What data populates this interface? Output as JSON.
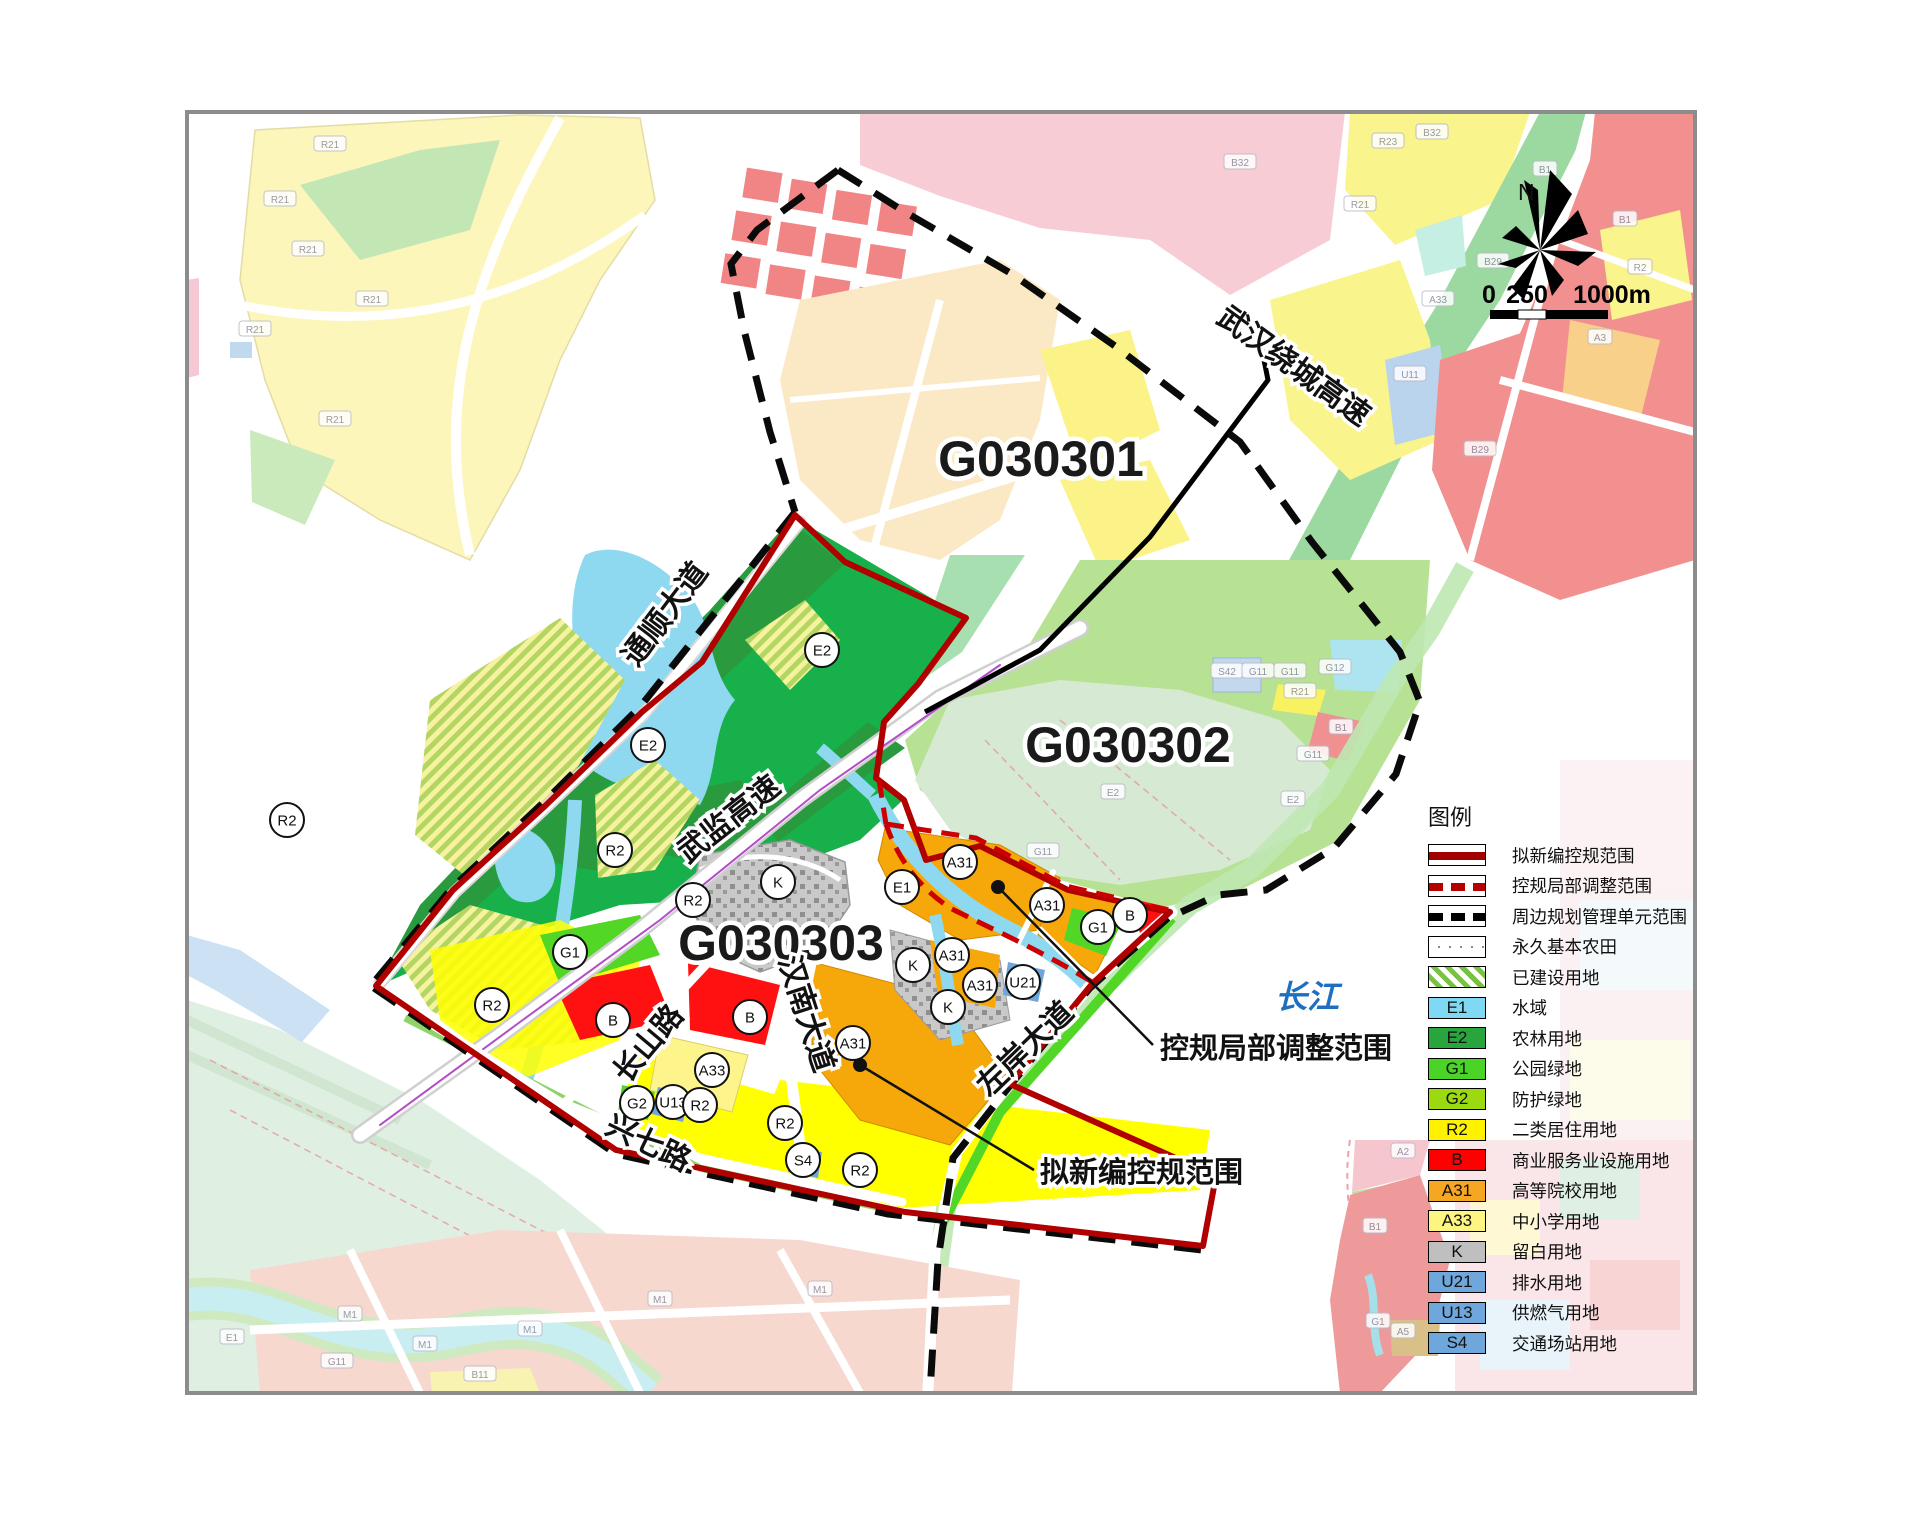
{
  "map": {
    "unit_labels": [
      {
        "text": "G030301",
        "x": 1041,
        "y": 476
      },
      {
        "text": "G030302",
        "x": 1128,
        "y": 762
      },
      {
        "text": "G030303",
        "x": 781,
        "y": 960
      }
    ],
    "road_labels": [
      {
        "text": "通顺大道",
        "x": 673,
        "y": 620,
        "rot": -53
      },
      {
        "text": "武监高速",
        "x": 735,
        "y": 827,
        "rot": -38
      },
      {
        "text": "武汉绕城高速",
        "x": 1288,
        "y": 374,
        "rot": 36
      },
      {
        "text": "长山路",
        "x": 656,
        "y": 1050,
        "rot": -50
      },
      {
        "text": "汉南大道",
        "x": 797,
        "y": 1017,
        "rot": 72
      },
      {
        "text": "兴七路",
        "x": 644,
        "y": 1152,
        "rot": 26
      },
      {
        "text": "左岸大道",
        "x": 1032,
        "y": 1056,
        "rot": -44
      }
    ],
    "river_label": {
      "text": "长江",
      "x": 1307,
      "y": 1008,
      "color": "#1f6fc0"
    },
    "annotations": [
      {
        "text": "控规局部调整范围",
        "tx": 1160,
        "ty": 1058,
        "dot": [
          998,
          887
        ],
        "end": [
          1153,
          1045
        ]
      },
      {
        "text": "拟新编控规范围",
        "tx": 1040,
        "ty": 1182,
        "dot": [
          860,
          1065
        ],
        "end": [
          1034,
          1170
        ]
      }
    ],
    "parcel_circles": [
      {
        "code": "E2",
        "x": 822,
        "y": 650
      },
      {
        "code": "E2",
        "x": 648,
        "y": 745
      },
      {
        "code": "R2",
        "x": 287,
        "y": 820
      },
      {
        "code": "R2",
        "x": 615,
        "y": 850
      },
      {
        "code": "R2",
        "x": 693,
        "y": 900
      },
      {
        "code": "G1",
        "x": 570,
        "y": 952
      },
      {
        "code": "R2",
        "x": 492,
        "y": 1005
      },
      {
        "code": "B",
        "x": 613,
        "y": 1020
      },
      {
        "code": "B",
        "x": 750,
        "y": 1017
      },
      {
        "code": "A33",
        "x": 712,
        "y": 1070
      },
      {
        "code": "G2",
        "x": 637,
        "y": 1103
      },
      {
        "code": "U13",
        "x": 673,
        "y": 1102
      },
      {
        "code": "R2",
        "x": 700,
        "y": 1105
      },
      {
        "code": "R2",
        "x": 785,
        "y": 1123
      },
      {
        "code": "S4",
        "x": 803,
        "y": 1160
      },
      {
        "code": "R2",
        "x": 860,
        "y": 1170
      },
      {
        "code": "A31",
        "x": 853,
        "y": 1043
      },
      {
        "code": "K",
        "x": 778,
        "y": 882
      },
      {
        "code": "E1",
        "x": 902,
        "y": 887
      },
      {
        "code": "A31",
        "x": 960,
        "y": 862
      },
      {
        "code": "A31",
        "x": 1047,
        "y": 905
      },
      {
        "code": "A31",
        "x": 952,
        "y": 955
      },
      {
        "code": "A31",
        "x": 980,
        "y": 985
      },
      {
        "code": "K",
        "x": 913,
        "y": 965
      },
      {
        "code": "K",
        "x": 948,
        "y": 1007
      },
      {
        "code": "U21",
        "x": 1023,
        "y": 982
      },
      {
        "code": "G1",
        "x": 1098,
        "y": 927
      },
      {
        "code": "B",
        "x": 1130,
        "y": 915
      }
    ],
    "small_labels": [
      {
        "text": "R21",
        "x": 330,
        "y": 145
      },
      {
        "text": "R21",
        "x": 280,
        "y": 200
      },
      {
        "text": "R21",
        "x": 308,
        "y": 250
      },
      {
        "text": "R21",
        "x": 255,
        "y": 330
      },
      {
        "text": "R21",
        "x": 372,
        "y": 300
      },
      {
        "text": "R21",
        "x": 335,
        "y": 420
      },
      {
        "text": "B32",
        "x": 1240,
        "y": 163
      },
      {
        "text": "B32",
        "x": 1432,
        "y": 133
      },
      {
        "text": "R23",
        "x": 1388,
        "y": 142
      },
      {
        "text": "R21",
        "x": 1360,
        "y": 205
      },
      {
        "text": "B1",
        "x": 1545,
        "y": 170
      },
      {
        "text": "B29",
        "x": 1493,
        "y": 262
      },
      {
        "text": "A33",
        "x": 1438,
        "y": 300
      },
      {
        "text": "U11",
        "x": 1410,
        "y": 375
      },
      {
        "text": "B1",
        "x": 1625,
        "y": 220
      },
      {
        "text": "R2",
        "x": 1640,
        "y": 268
      },
      {
        "text": "B29",
        "x": 1480,
        "y": 450
      },
      {
        "text": "A3",
        "x": 1600,
        "y": 338
      },
      {
        "text": "S42",
        "x": 1227,
        "y": 672
      },
      {
        "text": "G11",
        "x": 1258,
        "y": 672
      },
      {
        "text": "G11",
        "x": 1290,
        "y": 672
      },
      {
        "text": "G12",
        "x": 1335,
        "y": 668
      },
      {
        "text": "R21",
        "x": 1300,
        "y": 692
      },
      {
        "text": "B1",
        "x": 1341,
        "y": 728
      },
      {
        "text": "G11",
        "x": 1313,
        "y": 755
      },
      {
        "text": "E2",
        "x": 1293,
        "y": 800
      },
      {
        "text": "G11",
        "x": 1043,
        "y": 852
      },
      {
        "text": "E2",
        "x": 1113,
        "y": 793
      },
      {
        "text": "M1",
        "x": 350,
        "y": 1315
      },
      {
        "text": "M1",
        "x": 425,
        "y": 1345
      },
      {
        "text": "M1",
        "x": 530,
        "y": 1330
      },
      {
        "text": "E1",
        "x": 232,
        "y": 1338
      },
      {
        "text": "G11",
        "x": 337,
        "y": 1362
      },
      {
        "text": "B11",
        "x": 480,
        "y": 1375
      },
      {
        "text": "M1",
        "x": 660,
        "y": 1300
      },
      {
        "text": "M1",
        "x": 820,
        "y": 1290
      },
      {
        "text": "B1",
        "x": 1375,
        "y": 1227
      },
      {
        "text": "G1",
        "x": 1378,
        "y": 1322
      },
      {
        "text": "A5",
        "x": 1403,
        "y": 1332
      },
      {
        "text": "A2",
        "x": 1403,
        "y": 1152
      }
    ],
    "compass": {
      "label": "N",
      "nx": 1518,
      "ny": 200,
      "cx": 1540,
      "cy": 250
    },
    "scale_bar": {
      "labels": [
        {
          "text": "0",
          "x": 1489,
          "y": 303
        },
        {
          "text": "250",
          "x": 1527,
          "y": 303
        },
        {
          "text": "1000m",
          "x": 1612,
          "y": 303
        }
      ],
      "bar": {
        "x": 1490,
        "y": 310,
        "h": 9,
        "seg1": 28,
        "seg2": 28,
        "seg3": 62
      }
    }
  },
  "legend": {
    "title": "图例",
    "items": [
      {
        "type": "line-solid",
        "label": "拟新编控规范围"
      },
      {
        "type": "line-dashred",
        "label": "控规局部调整范围"
      },
      {
        "type": "line-dashblk",
        "label": "周边规划管理单元范围"
      },
      {
        "type": "grid",
        "label": "永久基本农田"
      },
      {
        "type": "hatch",
        "label": "已建设用地"
      },
      {
        "type": "swatch",
        "code": "E1",
        "color": "#7fd9f2",
        "label": "水域"
      },
      {
        "type": "swatch",
        "code": "E2",
        "color": "#28a53c",
        "label": "农林用地"
      },
      {
        "type": "swatch",
        "code": "G1",
        "color": "#4ad427",
        "label": "公园绿地"
      },
      {
        "type": "swatch",
        "code": "G2",
        "color": "#9bd911",
        "label": "防护绿地"
      },
      {
        "type": "swatch",
        "code": "R2",
        "color": "#fff200",
        "label": "二类居住用地"
      },
      {
        "type": "swatch",
        "code": "B",
        "color": "#ff0000",
        "label": "商业服务业设施用地"
      },
      {
        "type": "swatch",
        "code": "A31",
        "color": "#f5a623",
        "label": "高等院校用地"
      },
      {
        "type": "swatch",
        "code": "A33",
        "color": "#fdf582",
        "label": "中小学用地"
      },
      {
        "type": "swatch",
        "code": "K",
        "color": "#bfbfbf",
        "label": "留白用地"
      },
      {
        "type": "swatch",
        "code": "U21",
        "color": "#6fa7dc",
        "label": "排水用地"
      },
      {
        "type": "swatch",
        "code": "U13",
        "color": "#6fa7dc",
        "label": "供燃气用地"
      },
      {
        "type": "swatch",
        "code": "S4",
        "color": "#6fa7dc",
        "label": "交通场站用地"
      }
    ]
  },
  "colors": {
    "boundary_new_plan": "#b00000",
    "boundary_adjust": "#cc0000",
    "boundary_unit": "#0a0a0a",
    "river_text": "#1f6fc0"
  }
}
